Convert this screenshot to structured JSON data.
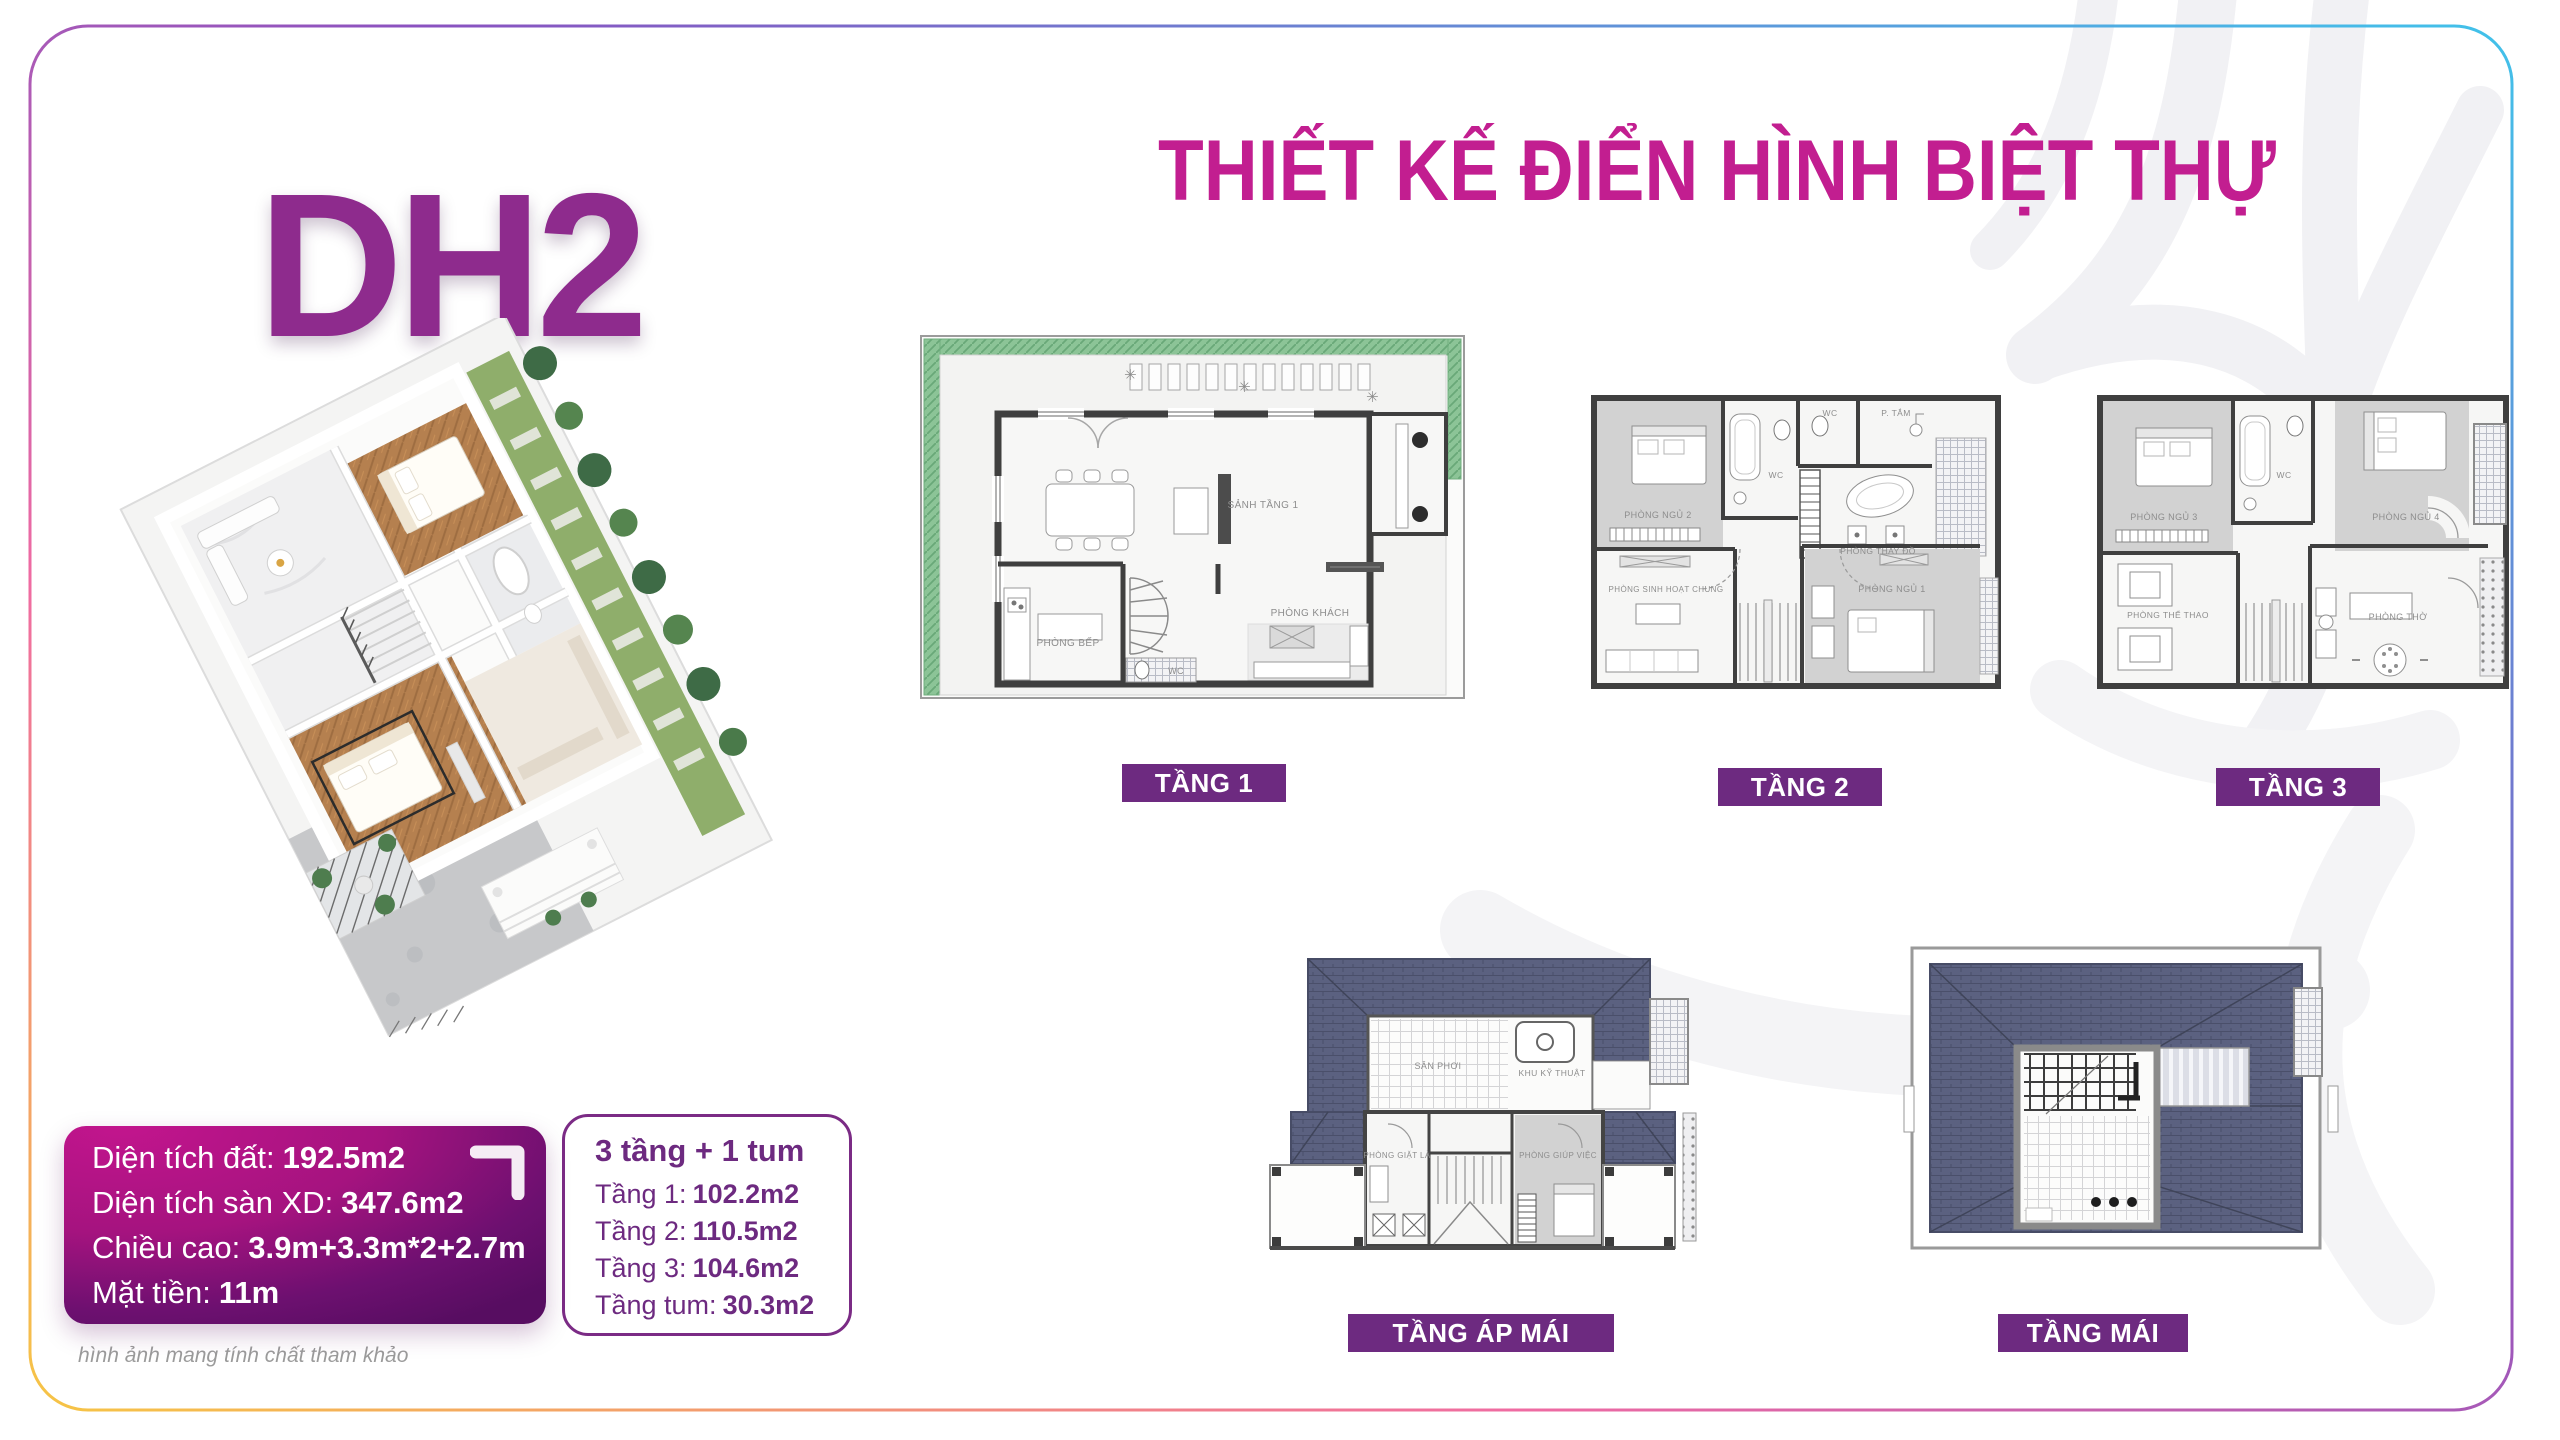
{
  "header": {
    "model_code": "DH2",
    "title": "THIẾT KẾ ĐIỂN HÌNH BIỆT THỰ"
  },
  "specs": {
    "items": [
      {
        "label": "Diện tích đất:",
        "value": "192.5m2"
      },
      {
        "label": "Diện tích sàn XD:",
        "value": "347.6m2"
      },
      {
        "label": "Chiều cao:",
        "value": "3.9m+3.3m*2+2.7m"
      },
      {
        "label": "Mặt tiền:",
        "value": "11m"
      }
    ]
  },
  "floor_summary": {
    "title": "3 tầng + 1 tum",
    "items": [
      {
        "label": "Tầng 1:",
        "value": "102.2m2"
      },
      {
        "label": "Tầng 2:",
        "value": "110.5m2"
      },
      {
        "label": "Tầng 3:",
        "value": "104.6m2"
      },
      {
        "label": "Tầng tum:",
        "value": "30.3m2"
      }
    ]
  },
  "floor_plans": [
    {
      "label": "TẦNG 1",
      "rooms": [
        "SẢNH TẦNG 1",
        "PHÒNG BẾP",
        "PHÒNG KHÁCH",
        "WC"
      ]
    },
    {
      "label": "TẦNG 2",
      "rooms": [
        "PHÒNG NGỦ 2",
        "WC",
        "WC",
        "P. TẮM",
        "PHÒNG THAY ĐỒ",
        "PHÒNG SINH HOẠT CHUNG",
        "PHÒNG NGỦ 1"
      ]
    },
    {
      "label": "TẦNG 3",
      "rooms": [
        "PHÒNG NGỦ 3",
        "WC",
        "PHÒNG NGỦ 4",
        "PHÒNG THỂ THAO",
        "PHÒNG THỜ"
      ]
    },
    {
      "label": "TẦNG ÁP MÁI",
      "rooms": [
        "SÂN PHƠI",
        "KHU KỸ THUẬT",
        "PHÒNG GIẶT LÀ",
        "PHÒNG GIÚP VIỆC"
      ]
    },
    {
      "label": "TẦNG MÁI",
      "rooms": []
    }
  ],
  "footer": {
    "disclaimer": "hình ảnh mang tính chất tham khảo"
  },
  "icons": {
    "spec_corner": "corner-bracket-icon"
  },
  "colors": {
    "title_magenta": "#c21e90",
    "model_purple": "#8e2b8d",
    "label_purple": "#6d2a80",
    "spec_box_gradient": [
      "#c2158d",
      "#570d61"
    ],
    "roof_slate": "#5b6180",
    "garden_green": "#8cc497",
    "border_gradient": [
      "#f6c544",
      "#ef6ba2",
      "#8a52c0",
      "#41c2ea"
    ]
  }
}
